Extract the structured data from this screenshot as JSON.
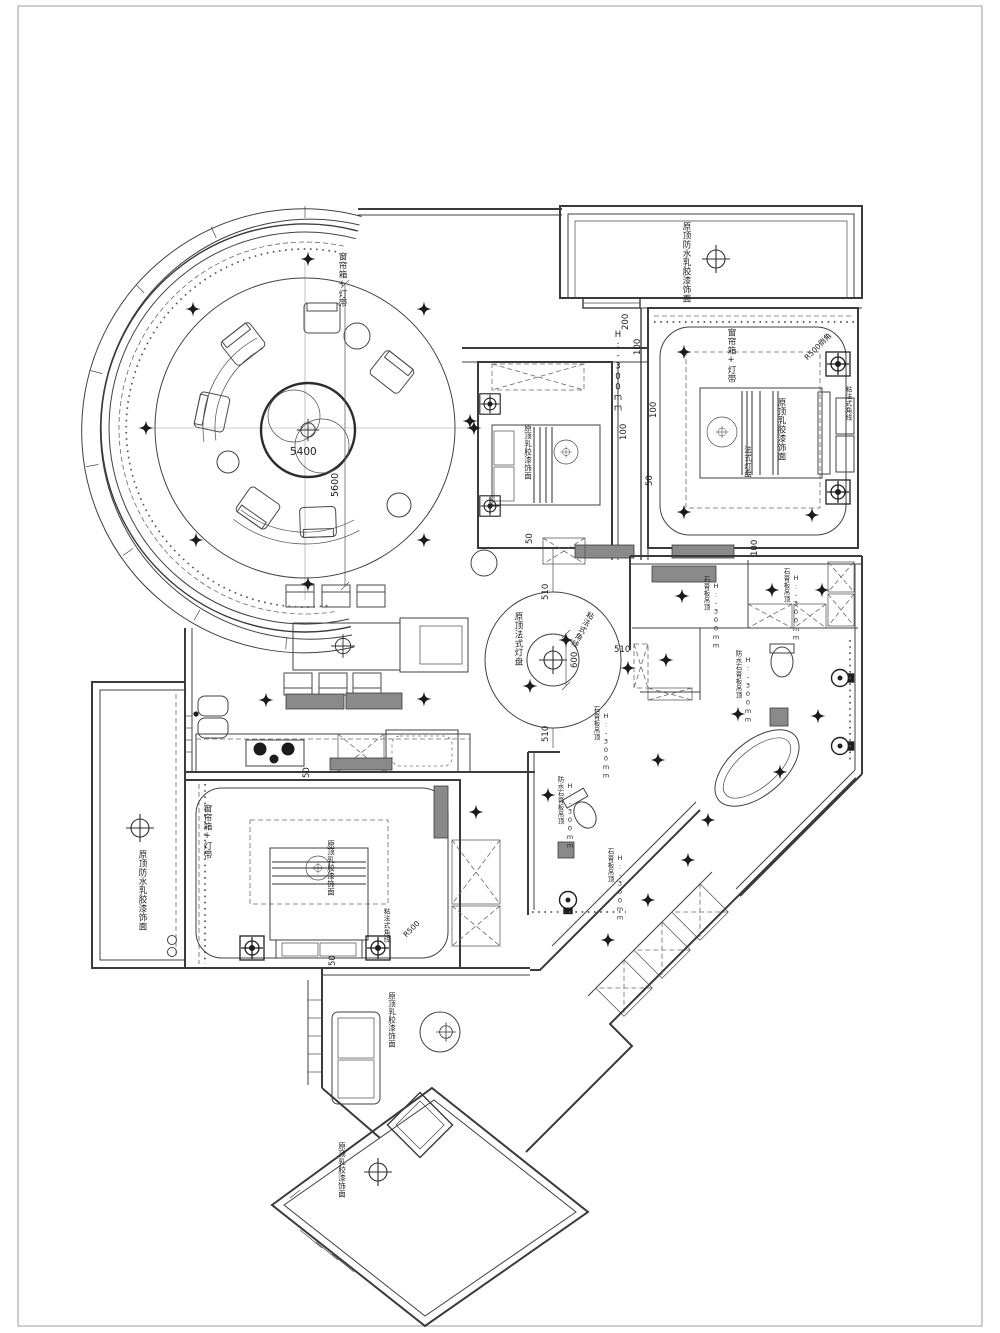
{
  "drawing": {
    "type": "residential ceiling & furniture plan",
    "labels": {
      "curtain_lamp": "窗帘箱+灯带",
      "waterproof_latex": "原顶防水乳胶漆饰面",
      "latex": "原顶乳胶漆饰面",
      "french_plate": "原顶法式灯盘",
      "french_disc": "法式灯盘",
      "corner_line": "粘法式角线",
      "gypsum": "石膏板吊顶",
      "wp_gypsum": "防水石膏板吊顶",
      "height": "H:-300mm",
      "r500_chamfer": "R500倒角",
      "r500": "R500"
    },
    "dims": {
      "d5600": "5600",
      "d5400": "5400",
      "d600": "600",
      "d510": "510",
      "d200": "200",
      "d100": "100",
      "d50": "50"
    },
    "colors": {
      "line": "#3b3b3b",
      "fill_gray": "#8a8a8a",
      "paper": "#ffffff"
    }
  }
}
